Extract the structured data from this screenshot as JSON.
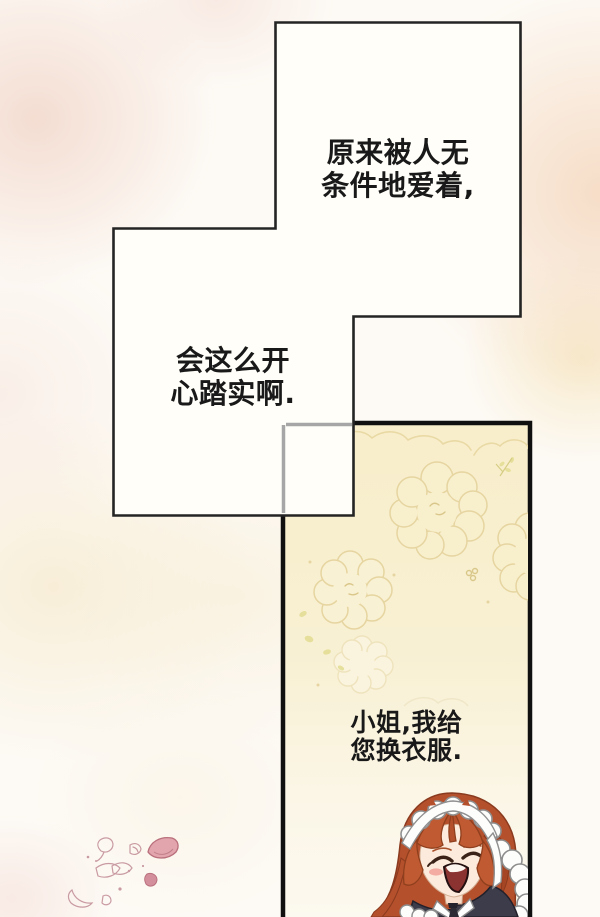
{
  "page": {
    "kind": "comic-page",
    "language": "zh",
    "bubbles": [
      {
        "lines": [
          "原来被人无",
          "条件地爱着,"
        ]
      },
      {
        "lines": [
          "会这么开",
          "心踏实啊."
        ]
      }
    ],
    "dialogue": {
      "speaker": "maid",
      "lines": [
        "小姐,我给",
        "您换衣服."
      ]
    },
    "colors": {
      "background": "#fdfaf5",
      "speech_panel_fill": "#fffef9",
      "speech_panel_border": "#242424",
      "inset_panel_fill": "#f8eecb",
      "inset_panel_border": "#101010",
      "overlap_border_gray": "#a6a6a6",
      "doodle_outline": "#e6d5a0",
      "leaf_green": "#e2dc92",
      "hair_copper": "#b5502c",
      "dress_dark": "#3d3c4a",
      "blush_pink": "#f0968f",
      "mouth_red": "#8a3331",
      "petal_pink": "#e2a5ae",
      "text": "#191919"
    }
  }
}
